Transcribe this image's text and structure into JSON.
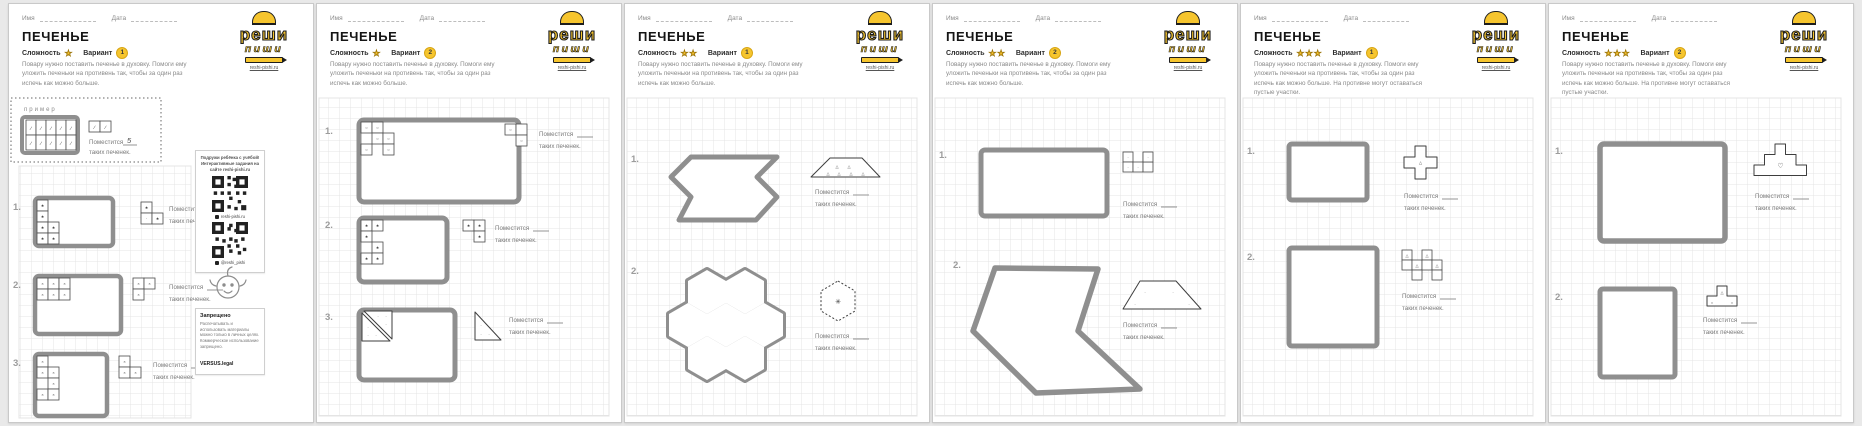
{
  "shared": {
    "name_label": "Имя",
    "date_label": "Дата",
    "title": "ПЕЧЕНЬЕ",
    "difficulty_label": "Сложность",
    "variant_label": "Вариант",
    "fits_label": "Поместится",
    "fits_suffix": "таких печенек.",
    "example_label": "пример",
    "example_answer": "5",
    "logo": {
      "word1": "реши",
      "word2": "пиши",
      "site": "reshi-pishi.ru"
    },
    "marks": {
      "slash": "∕",
      "star": "★",
      "cross": "×",
      "circle": "○",
      "dot": "·",
      "tri": "△",
      "heart": "♡",
      "spark": "✳"
    },
    "colors": {
      "accent": "#f6c52e",
      "tray": "#8f8f8f",
      "grid": "#e4e4e4",
      "ink": "#3c3c3c"
    }
  },
  "instructions": {
    "base": "Повару нужно поставить печенье в духовку. Помоги ему уложить печеньки на противень так, чтобы за один раз испечь как можно больше.",
    "extended": "Повару нужно поставить печенье в духовку. Помоги ему уложить печеньки на противень так, чтобы за один раз испечь как можно больше. На противне могут оставаться пустые участки."
  },
  "pages": [
    {
      "stars": "★",
      "variant": "1",
      "tasks": [
        "1.",
        "2.",
        "3."
      ]
    },
    {
      "stars": "★",
      "variant": "2",
      "tasks": [
        "1.",
        "2.",
        "3."
      ]
    },
    {
      "stars": "★★",
      "variant": "1",
      "tasks": [
        "1.",
        "2."
      ]
    },
    {
      "stars": "★★",
      "variant": "2",
      "tasks": [
        "1.",
        "2."
      ]
    },
    {
      "stars": "★★★",
      "variant": "1",
      "tasks": [
        "1.",
        "2."
      ]
    },
    {
      "stars": "★★★",
      "variant": "2",
      "tasks": [
        "1.",
        "2."
      ]
    }
  ],
  "sidebar": {
    "intro": "Подружи ребёнка с учёбой! Интерактивные задания на сайте reshi-pishi.ru",
    "qr1_caption": "reshi-pishi.ru",
    "qr2_caption": "@reshi_pishi",
    "forbidden_title": "Запрещено",
    "forbidden_text": "Распечатывать и использовать материалы можно только в личных целях. Коммерческое использование запрещено.",
    "forbidden_brand": "VERSUS.legal"
  }
}
